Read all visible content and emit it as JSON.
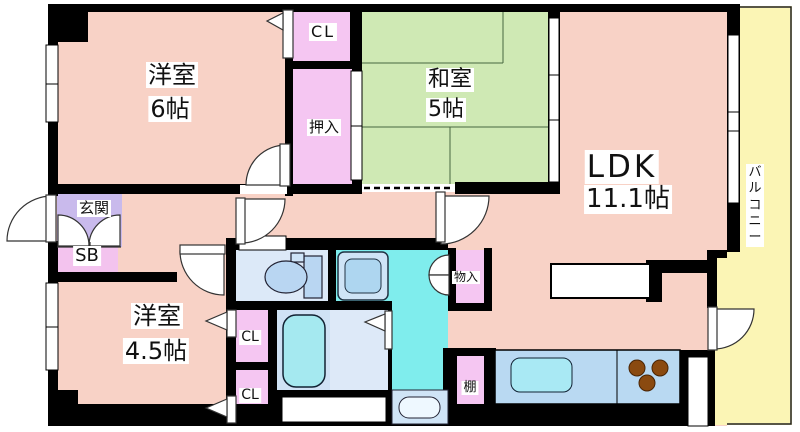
{
  "floorplan": {
    "title": "apartment-floor-plan",
    "rooms": {
      "western6": {
        "label": "洋室",
        "size": "6帖"
      },
      "japanese5": {
        "label": "和室",
        "size": "5帖"
      },
      "ldk": {
        "label": "LDK",
        "size": "11.1帖"
      },
      "western45": {
        "label": "洋室",
        "size": "4.5帖"
      },
      "entrance": {
        "label": "玄関"
      },
      "shoebox": {
        "label": "SB"
      },
      "closet_top": {
        "label": "CL"
      },
      "oshiire": {
        "label": "押入"
      },
      "closet_mid": {
        "label": "CL"
      },
      "closet_bottom": {
        "label": "CL"
      },
      "storage": {
        "label": "物入"
      },
      "shelf": {
        "label": "棚"
      },
      "balcony": {
        "label": "バルコニー"
      }
    },
    "colors": {
      "floor_pink": "#f8d2c6",
      "tatami_green": "#cfe9b4",
      "closet_pink": "#f5c6f2",
      "entrance_purple": "#c9baec",
      "balcony_yellow": "#fbf5b5",
      "water_cyan": "#7feded",
      "fixture_blue": "#b9d9f2",
      "stove_brown": "#8a4a10",
      "wall_black": "#000000"
    }
  }
}
